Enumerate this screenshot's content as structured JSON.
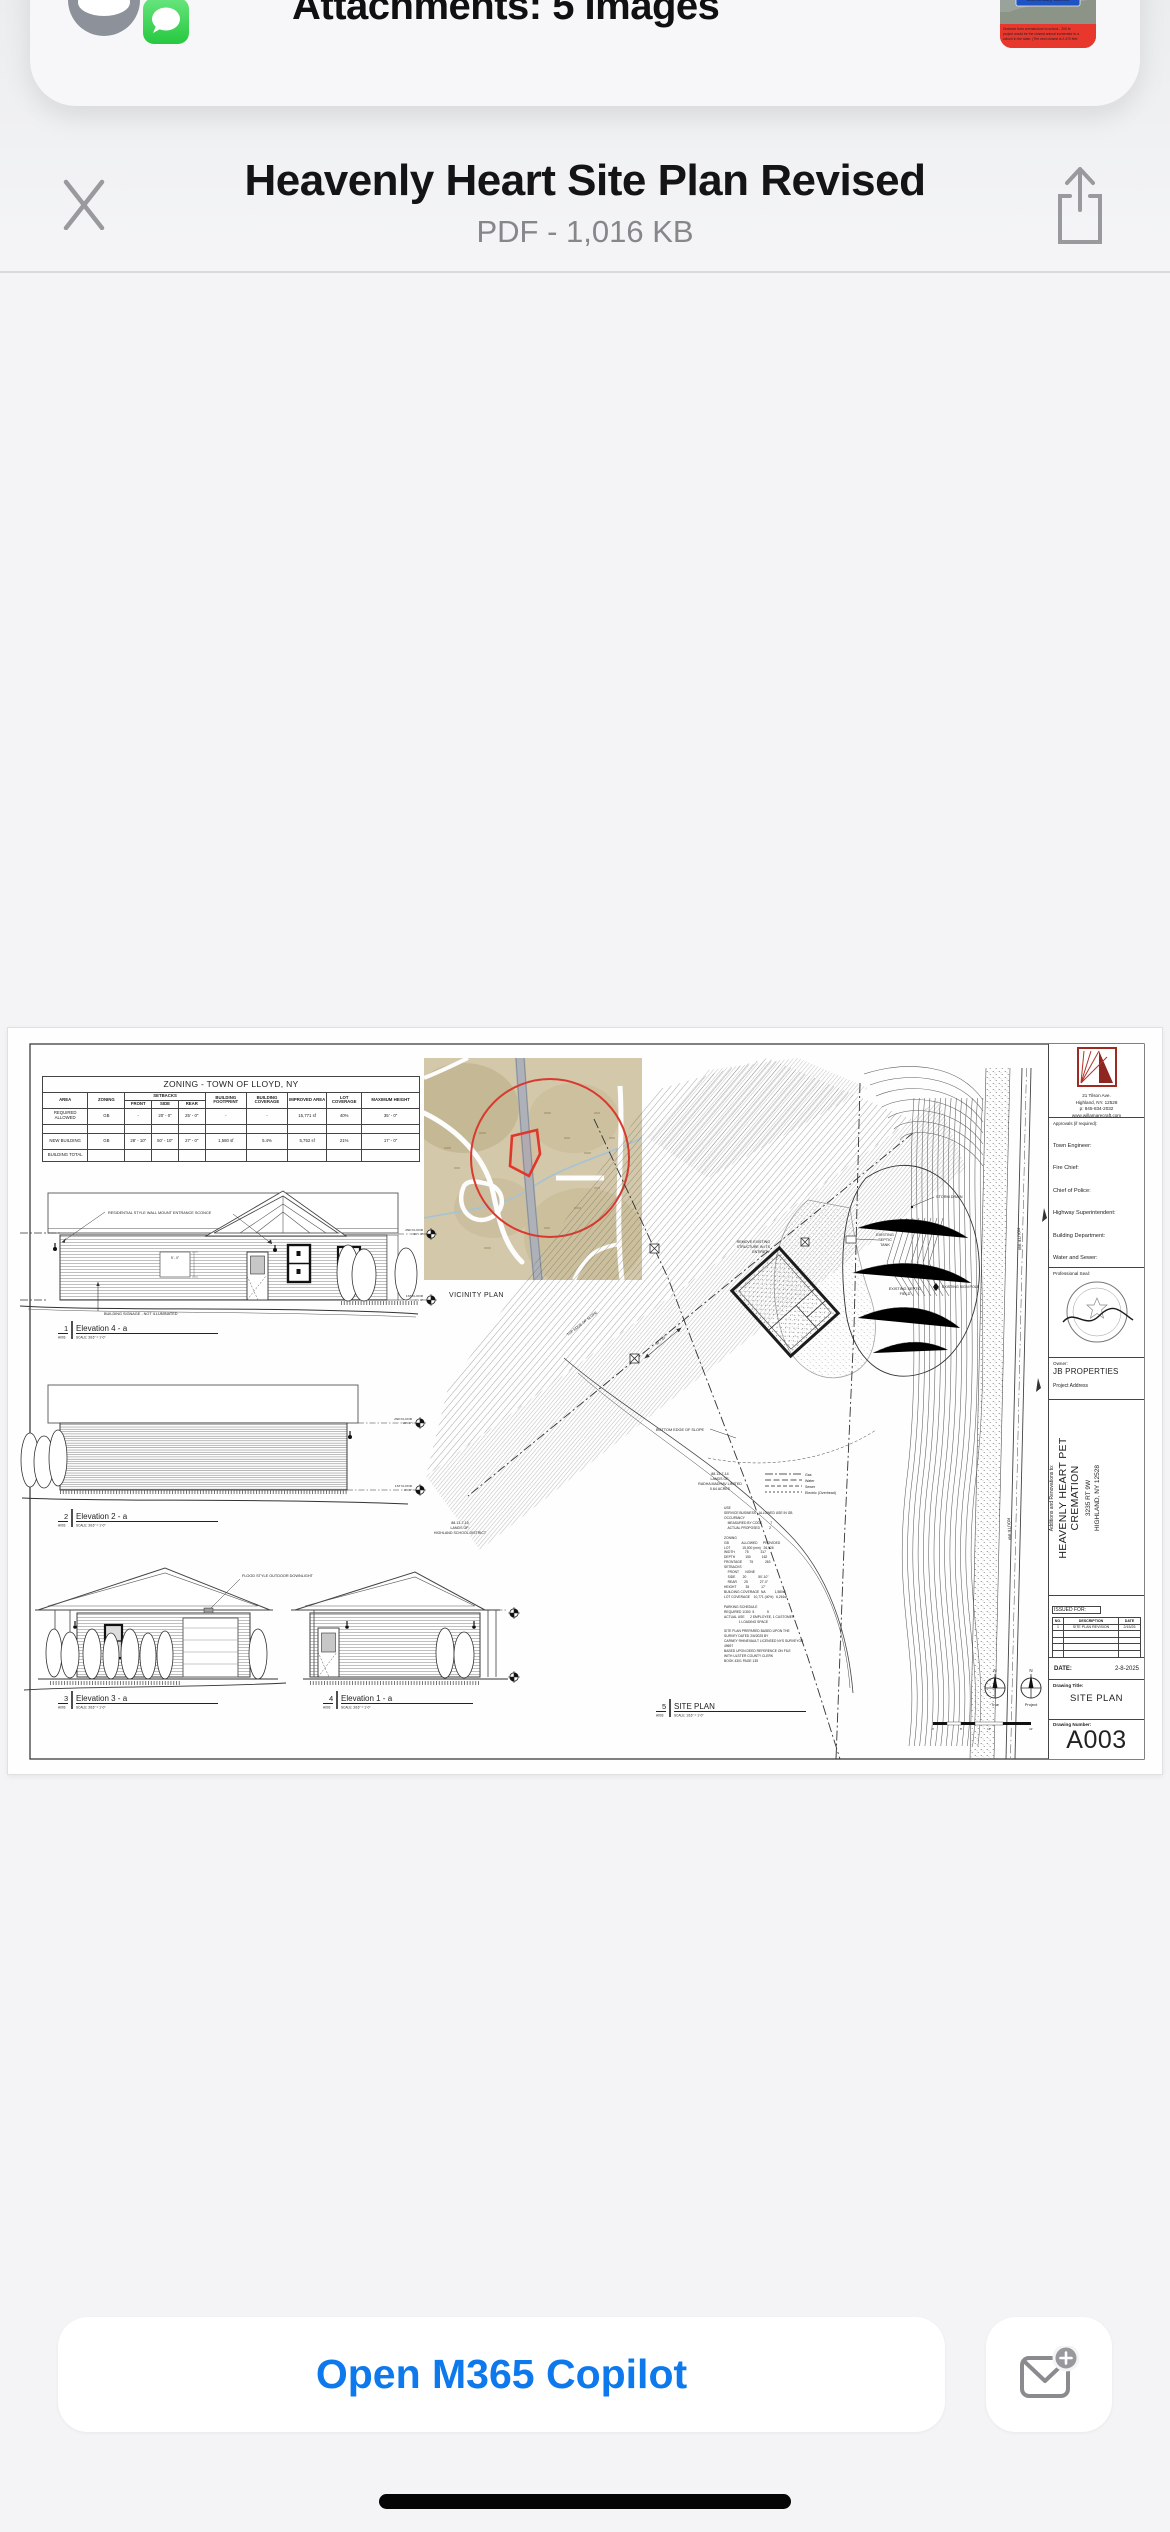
{
  "colors": {
    "accent_blue": "#0d79ec",
    "icon_gray": "#98989d",
    "sheet_white": "#fefefe",
    "bg_gray": "#f4f4f6",
    "map_tan": "#d3c8a9",
    "red_mark": "#d93a30",
    "messages_green": "#27c840"
  },
  "mail_card": {
    "title": "Attachments: 5 Images",
    "app_icon": "messages-icon",
    "thumb_sign": [
      "Highland",
      "Elementary School"
    ],
    "thumb_banner": [
      "Distance from crematorium to school - 200 fe",
      "project would be the closest animal incinerator to a",
      "school in the state. (The next closest is 2,470 feet"
    ]
  },
  "viewer_header": {
    "title": "Heavenly Heart Site Plan Revised",
    "subtitle": "PDF - 1,016 KB"
  },
  "footer": {
    "open_button": "Open M365 Copilot"
  },
  "doc": {
    "ztable": {
      "title": "ZONING - TOWN OF LLOYD, NY",
      "col_area": "AREA",
      "col_zoning": "ZONING",
      "col_setbacks": "SETBACKS",
      "col_front": "FRONT",
      "col_side": "SIDE",
      "col_rear": "REAR",
      "col_footprint": "BUILDING FOOTPRINT",
      "col_coverage": "BUILDING COVERAGE",
      "col_improved": "IMPROVED AREA",
      "col_lot": "LOT COVERAGE",
      "col_height": "MAXIMUM HEIGHT",
      "rows": [
        [
          "REQUIRED ALLOWED",
          "GB",
          "-",
          "20' - 0\"",
          "25' - 0\"",
          "-",
          "-",
          "15,771 sf",
          "40%",
          "35' - 0\""
        ],
        [
          "",
          "",
          "",
          "",
          "",
          "",
          "",
          "",
          "",
          ""
        ],
        [
          "NEW BUILDING",
          "GB",
          "28' - 10\"",
          "50' - 10\"",
          "27' - 0\"",
          "1,580 sf",
          "5.4%",
          "5,752 sf",
          "21%",
          "17' - 0\""
        ],
        [
          "BUILDING TOTAL",
          "",
          "",
          "",
          "",
          "",
          "",
          "",
          "",
          ""
        ]
      ]
    },
    "vicinity_label": "VICINITY PLAN",
    "e1": {
      "num": "1",
      "name": "Elevation 4 - a",
      "sheet": "A003",
      "scale": "SCALE: 3/16\" = 1'-0\""
    },
    "e2": {
      "num": "2",
      "name": "Elevation 2 - a",
      "sheet": "A003",
      "scale": "SCALE: 3/16\" = 1'-0\""
    },
    "e3": {
      "num": "3",
      "name": "Elevation 3 - a",
      "sheet": "A003",
      "scale": "SCALE: 3/16\" = 1'-0\""
    },
    "e4": {
      "num": "4",
      "name": "Elevation 1 - a",
      "sheet": "A003",
      "scale": "SCALE: 3/16\" = 1'-0\""
    },
    "e5": {
      "num": "5",
      "name": "SITE PLAN",
      "sheet": "A003",
      "scale": "SCALE: 1/16\" = 1'-0\""
    },
    "ann": {
      "sconce": "RESIDENTIAL STYLE WALL MOUNT ENTRANCE SCONCE",
      "signage": "BUILDING SIGNAGE - NOT ILLUMINATED",
      "downlight": "FLOOD STYLE OUTDOOR DOWNLIGHT",
      "dim_window": "5' - 0\"",
      "dim_side": "50' - 10\""
    },
    "floors": {
      "f2": [
        "2ND FLOOR",
        "10' - 0\""
      ],
      "f1": [
        "1ST FLOOR",
        "0' - 0\""
      ]
    },
    "plan": {
      "storm": "STORM DRAIN",
      "septic": [
        "EXISTING",
        "SEPTIC",
        "TANK"
      ],
      "field": [
        "EXISTING SEPTIC",
        "FIELD"
      ],
      "bottom": "BOTTOM EDGE OF SLOPE",
      "top": "TOP EDGE OF SLOPE",
      "route": "ROUTE 9W",
      "remove": [
        "REMOVE EXISTING",
        "STRUCTURE IN ITS",
        "ENTIRETY"
      ],
      "sign_pole": "EXISTING SIGN POLE",
      "parcel_school": [
        "88.13-7-15",
        "LANDS OF:",
        "HIGHLAND SCHOOL DISTRICT"
      ],
      "parcel_radha": [
        "88.13-7-14",
        "LANDS OF:",
        "RADHA MADHAV LIMITED",
        "0.64 ACRES"
      ],
      "legend": [
        "Gas",
        "Water",
        "Sewer",
        "Electric (Overhead)"
      ],
      "compass": {
        "n": "N",
        "true": "True",
        "project": "Project"
      },
      "scalebar": [
        "0'",
        "8'",
        "16'",
        "32'"
      ]
    },
    "notes": "USE\nSERVICE BUSINESS - ALLOWED USE IN GB\nOCCUPANCY\n    MEASURED BY CODE         7\n    ACTUAL PROPOSED          2\n\nZONING\nGB              ALLOWED      PROVIDED\nLOT             15,000 (min)   26,926\nWIDTH           75             317\nDEPTH           150            162\nFRONTAGE        75             263\nSETBACKS\n    FRONT       NONE\n    SIDE        20             50'-10\"\n    REAR        25             27'-0\"\nHEIGHT          35             17'\nBUILDING COVERAGE  NA          1,580sf\nLOT COVERAGE    10,771 (40%)   6,261sf\n\nPARKING SCHEDULE\nREQUIRED 1/300  5              5\nACTUAL USE      2 EMPLOYEE, 1 CUSTOMER\n                1 LOADING SPACE\n\nSITE PLAN PREPARED BASED UPON THE\nSURVEY DATED 2/6/2025 BY\nCARNEY RHINEVAULT LICENSED NYS SURVEYOR\n49697\nBASED UPON DEED REFERENCE ON FILE\nWITH ULSTER COUNTY CLERK\nBOOK 4301 PAGE 135",
    "tblock": {
      "address": [
        "21 Tilson Ave.",
        "Highland, NY. 12528",
        "p: 845-834-2032",
        "www.willamarecraft.com"
      ],
      "approvals_header": "Approvals (if required):",
      "approvals": [
        "Town Engineer:",
        "Fire Chief:",
        "Chief of Police:",
        "Highway Superintendent:",
        "Building Department:",
        "Water and Sewer:"
      ],
      "seal_label": "Professional Seal:",
      "owner_label": "Owner:",
      "owner": "JB PROPERTIES",
      "project_address_label": "Project Address",
      "project_intro": "Additions and Renovations to:",
      "project_name_1": "HEAVENLY HEART PET",
      "project_name_2": "CREMATION",
      "project_addr_1": "3235 RT 9W",
      "project_addr_2": "HIGHLAND, NY 12528",
      "issued_label": "ISSUED FOR:",
      "issued_cols": [
        "NO.",
        "DESCRIPTION",
        "DATE"
      ],
      "issued_row": [
        "1",
        "SITE PLAN REVISION",
        "2/15/25"
      ],
      "date_label": "DATE:",
      "date": "2-8-2025",
      "drawing_title_label": "Drawing Title:",
      "drawing_title": "SITE PLAN",
      "drawing_number_label": "Drawing Number:",
      "drawing_number": "A003"
    }
  }
}
